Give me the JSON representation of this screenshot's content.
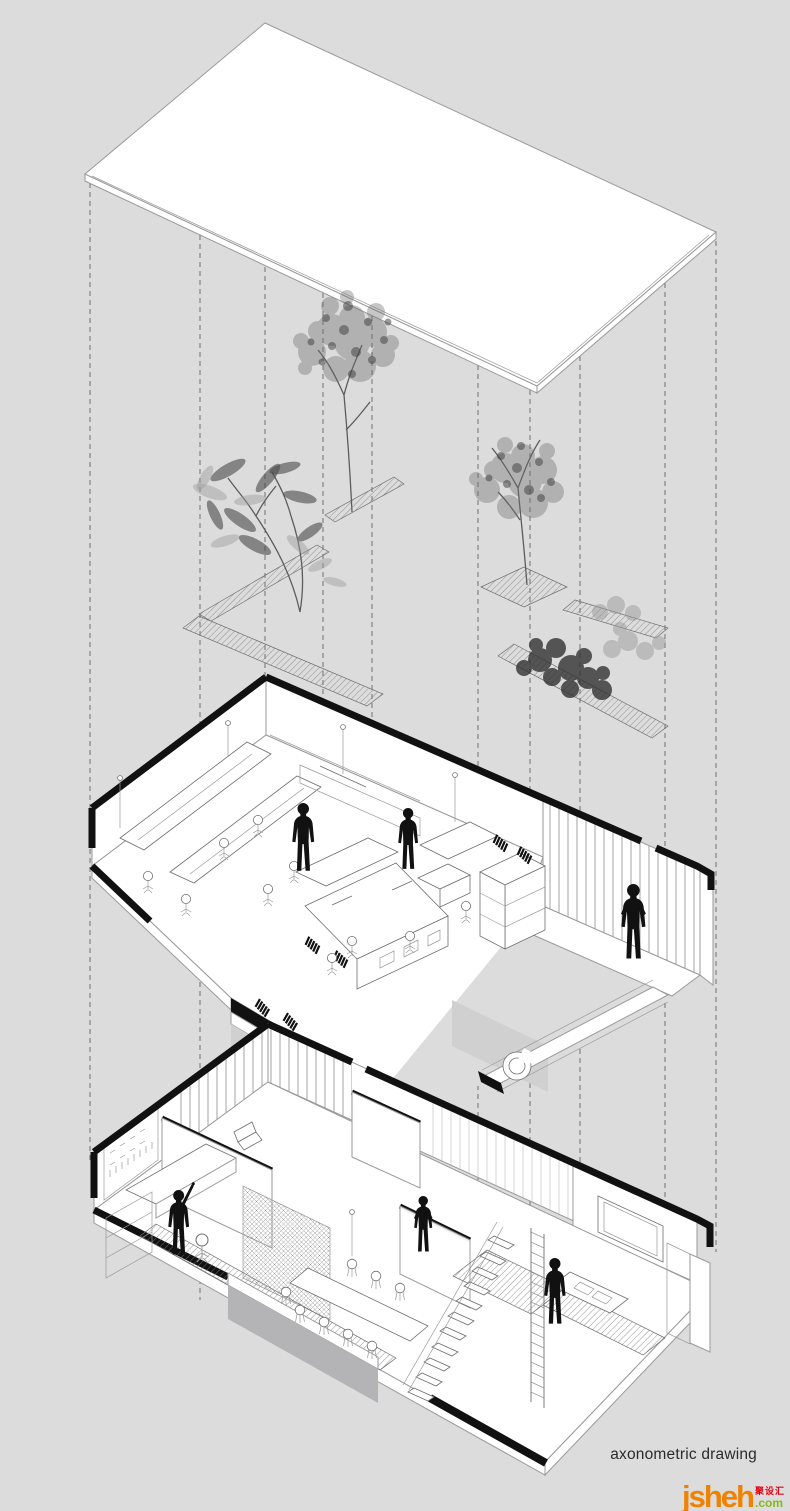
{
  "canvas": {
    "width": 790,
    "height": 1511
  },
  "caption": {
    "label": "axonometric drawing"
  },
  "logo": {
    "wordmark": "jsheh",
    "tld": ".com",
    "cjk": "聚设汇"
  },
  "colors": {
    "background": "#dcdcdd",
    "ink": "#111111",
    "line_light": "#9a9a9a",
    "line_mid": "#6f6f6f",
    "panel_gray": "#d0d0d1",
    "shadow_gray": "#b4b4b6",
    "foliage_mid": "#6e6e6e",
    "foliage_dark": "#3c3c3c",
    "caption": "#2a2a2a",
    "logo_orange": "#ef8200",
    "logo_green": "#86b71f",
    "logo_red": "#e60012"
  },
  "figure": {
    "type": "exploded-axonometric",
    "layers": [
      {
        "name": "roof-slab"
      },
      {
        "name": "courtyard-planting",
        "elements": [
          "tree",
          "tree",
          "broadleaf-plant",
          "shrub-bed",
          "hatched-planter-strips"
        ]
      },
      {
        "name": "upper-floor-plan",
        "elements": [
          "open-office-desks",
          "office-chairs",
          "book-stacks",
          "pendant-lights",
          "slatted-wall",
          "walkway",
          "people-silhouettes"
        ]
      },
      {
        "name": "ground-floor-plan",
        "elements": [
          "tool-wall-workshop",
          "dining-table-chairs",
          "stair",
          "ladder",
          "tv-wall",
          "kitchen-counter",
          "mesh-screen",
          "people-silhouettes"
        ]
      }
    ],
    "people_count": 6,
    "projection_line_count": 10
  }
}
